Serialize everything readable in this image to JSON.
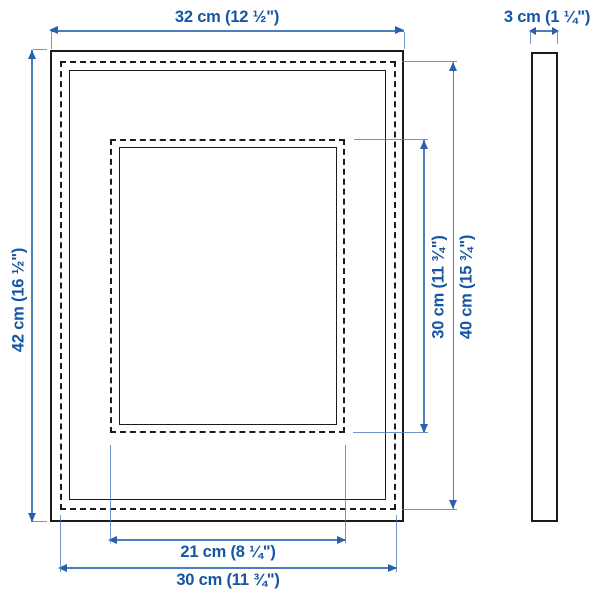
{
  "colors": {
    "outline": "#1c1c1c",
    "dimension_line": "#4d7cc1",
    "arrow": "#2a5fae",
    "dimension_text": "#1556a5",
    "background": "#ffffff"
  },
  "views": {
    "front": {
      "dims": {
        "outer_width": "32 cm (12 ½\")",
        "outer_height": "42 cm (16 ½\")",
        "picture_width": "30 cm (11 ¾\")",
        "picture_height": "40 cm (15 ¾\")",
        "mat_opening_width": "21 cm (8 ¼\")",
        "mat_opening_height": "30 cm (11 ¾\")"
      }
    },
    "side": {
      "dims": {
        "depth": "3 cm (1 ¼\")"
      }
    }
  },
  "icons": {
    "arrow-left-icon": "css-triangle-left",
    "arrow-right-icon": "css-triangle-right",
    "arrow-up-icon": "css-triangle-up",
    "arrow-down-icon": "css-triangle-down"
  }
}
